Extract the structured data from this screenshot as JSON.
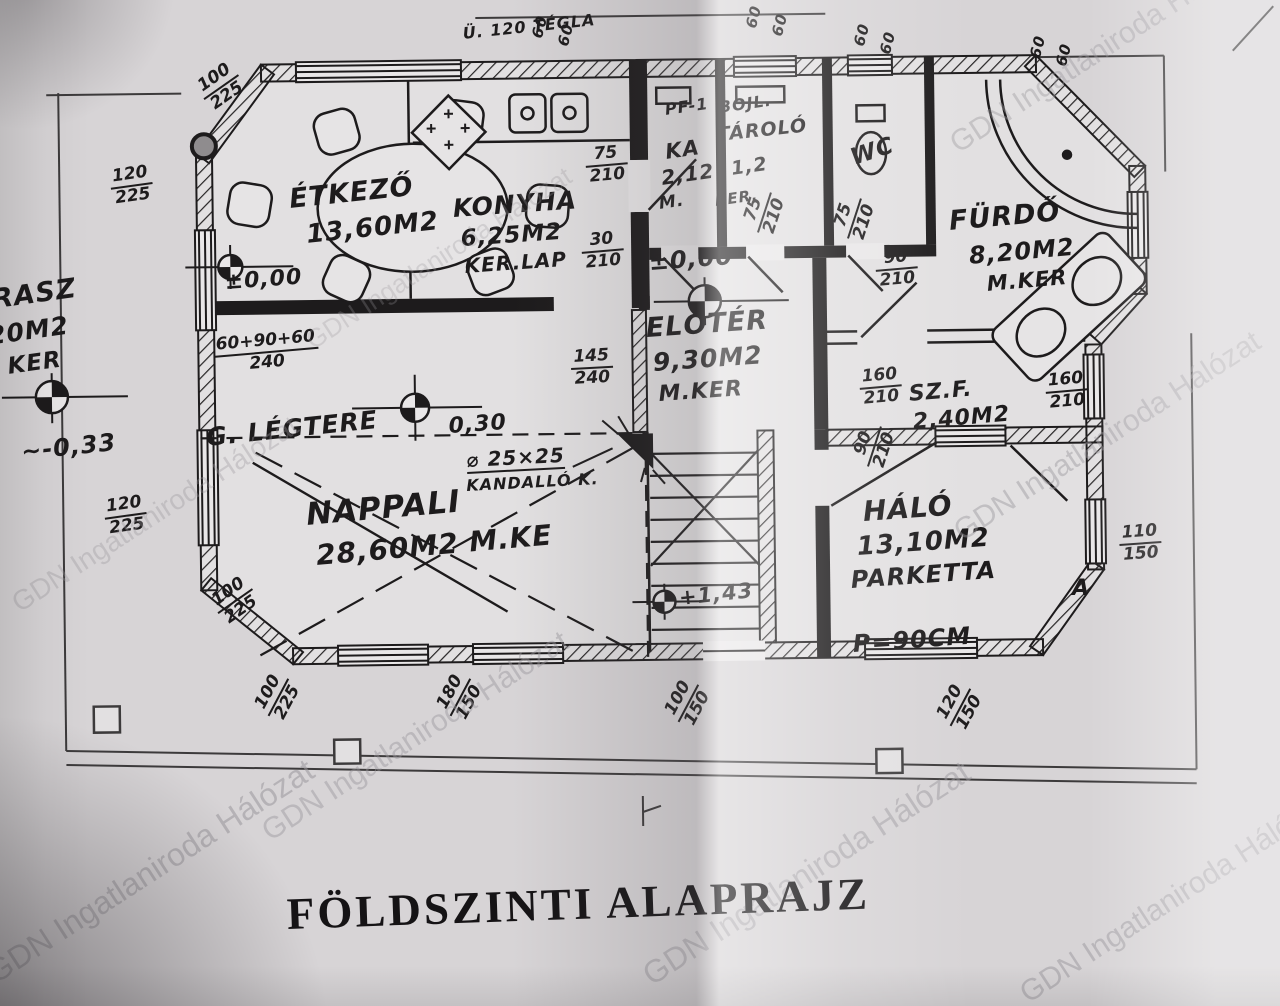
{
  "title": "FÖLDSZINTI ALAPRAJZ",
  "watermark_text": "GDN Ingatlaniroda Hálózat",
  "colors": {
    "paper": "#d7d4d6",
    "paper_bright": "#e9e7e8",
    "ink": "#1d1b1c",
    "watermark": "#9b989d"
  },
  "plan": {
    "labels": [
      {
        "n": "room-label-etkezo",
        "t": "ÉTKEZŐ",
        "x": 288,
        "y": 186,
        "s": 27,
        "r": -6
      },
      {
        "n": "room-area-etkezo",
        "t": "13,60M2",
        "x": 305,
        "y": 222,
        "s": 26,
        "r": -6
      },
      {
        "n": "room-label-konyha",
        "t": "KONYHA",
        "x": 452,
        "y": 196,
        "s": 25,
        "r": -4
      },
      {
        "n": "room-area-konyha",
        "t": "6,25M2",
        "x": 460,
        "y": 228,
        "s": 23,
        "r": -4
      },
      {
        "n": "room-floor-konyha",
        "t": "KER.LAP",
        "x": 464,
        "y": 256,
        "s": 20,
        "r": -4
      },
      {
        "n": "label-pf1",
        "t": "PF-1",
        "x": 664,
        "y": 102,
        "s": 16,
        "r": -8
      },
      {
        "n": "label-bojl",
        "t": "BOJL.",
        "x": 718,
        "y": 100,
        "s": 16,
        "r": -8
      },
      {
        "n": "room-label-tarolo",
        "t": "TÁROLÓ",
        "x": 716,
        "y": 126,
        "s": 19,
        "r": -6
      },
      {
        "n": "room-area-tarolo",
        "t": "1,2",
        "x": 730,
        "y": 160,
        "s": 19,
        "r": -8
      },
      {
        "n": "room-label-ka",
        "t": "KA",
        "x": 664,
        "y": 142,
        "s": 21,
        "r": -8
      },
      {
        "n": "room-area-ka",
        "t": "2,12",
        "x": 660,
        "y": 168,
        "s": 20,
        "r": -8
      },
      {
        "n": "room-floor-ka-m",
        "t": "M.",
        "x": 658,
        "y": 196,
        "s": 17,
        "r": -8
      },
      {
        "n": "room-floor-ka-ker",
        "t": "KER.",
        "x": 714,
        "y": 194,
        "s": 15,
        "r": -8
      },
      {
        "n": "room-label-wc",
        "t": "WC",
        "x": 848,
        "y": 148,
        "s": 23,
        "r": -18
      },
      {
        "n": "room-label-furdo",
        "t": "FÜRDŐ",
        "x": 948,
        "y": 208,
        "s": 27,
        "r": -5
      },
      {
        "n": "room-area-furdo",
        "t": "8,20M2",
        "x": 968,
        "y": 244,
        "s": 24,
        "r": -5
      },
      {
        "n": "room-floor-furdo",
        "t": "M.KER",
        "x": 986,
        "y": 274,
        "s": 21,
        "r": -5
      },
      {
        "n": "level-eloter",
        "t": "±0,00",
        "x": 648,
        "y": 250,
        "s": 24,
        "r": -4
      },
      {
        "n": "room-label-eloter",
        "t": "ELŐTÉR",
        "x": 645,
        "y": 315,
        "s": 27,
        "r": -4
      },
      {
        "n": "room-area-eloter",
        "t": "9,30M2",
        "x": 652,
        "y": 350,
        "s": 25,
        "r": -4
      },
      {
        "n": "room-floor-eloter",
        "t": "M.KER",
        "x": 658,
        "y": 384,
        "s": 22,
        "r": -4
      },
      {
        "n": "level-etkezo",
        "t": "±0,00",
        "x": 224,
        "y": 272,
        "s": 22,
        "r": -4
      },
      {
        "n": "room-label-szf",
        "t": "SZ.F.",
        "x": 908,
        "y": 384,
        "s": 22,
        "r": -5
      },
      {
        "n": "room-area-szf",
        "t": "2,40M2",
        "x": 912,
        "y": 412,
        "s": 22,
        "r": -5
      },
      {
        "n": "room-label-nappali",
        "t": "NAPPALI",
        "x": 305,
        "y": 500,
        "s": 31,
        "r": -5
      },
      {
        "n": "room-area-nappali",
        "t": "28,60M2 M.KE",
        "x": 315,
        "y": 542,
        "s": 28,
        "r": -5
      },
      {
        "n": "label-g-legtere",
        "t": "G. LÉGTERE",
        "x": 205,
        "y": 425,
        "s": 25,
        "r": -6
      },
      {
        "n": "level-nappali",
        "t": "0,30",
        "x": 448,
        "y": 416,
        "s": 22,
        "r": -4
      },
      {
        "n": "label-kandallo-size",
        "t": "⌀ 25×25",
        "x": 466,
        "y": 450,
        "s": 20,
        "r": -3,
        "u": true
      },
      {
        "n": "label-kandallo",
        "t": "KANDALLÓ K.",
        "x": 466,
        "y": 478,
        "s": 16,
        "r": -3
      },
      {
        "n": "room-label-halo",
        "t": "HÁLÓ",
        "x": 862,
        "y": 498,
        "s": 28,
        "r": -4
      },
      {
        "n": "room-area-halo",
        "t": "13,10M2",
        "x": 856,
        "y": 534,
        "s": 26,
        "r": -4
      },
      {
        "n": "room-floor-halo",
        "t": "PARKETTA",
        "x": 850,
        "y": 568,
        "s": 24,
        "r": -4
      },
      {
        "n": "label-parapet",
        "t": "P=90CM",
        "x": 852,
        "y": 632,
        "s": 24,
        "r": -4
      },
      {
        "n": "label-section-a",
        "t": "A",
        "x": 1072,
        "y": 578,
        "s": 22,
        "r": 0
      },
      {
        "n": "level-stairs",
        "t": "+1,43",
        "x": 678,
        "y": 588,
        "s": 21,
        "r": -6
      },
      {
        "n": "room-label-terasz",
        "t": "TERASZ",
        "x": -48,
        "y": 292,
        "s": 27,
        "r": -8
      },
      {
        "n": "room-area-terasz",
        "t": "5,20M2",
        "x": -42,
        "y": 328,
        "s": 25,
        "r": -8
      },
      {
        "n": "room-floor-terasz",
        "t": "M. KER",
        "x": -36,
        "y": 362,
        "s": 23,
        "r": -8
      },
      {
        "n": "level-terasz",
        "t": "~-0,33",
        "x": 20,
        "y": 440,
        "s": 24,
        "r": -6
      },
      {
        "n": "label-u120-tegla",
        "t": "Ü. 120 TÉGLA",
        "x": 462,
        "y": 26,
        "s": 16,
        "r": -6
      },
      {
        "n": "dim-window-60",
        "t": "60",
        "x": 530,
        "y": 36,
        "s": 15,
        "r": -75
      },
      {
        "n": "dim-window-60",
        "t": "60",
        "x": 556,
        "y": 44,
        "s": 15,
        "r": -75
      },
      {
        "n": "dim-window-60",
        "t": "60",
        "x": 744,
        "y": 26,
        "s": 15,
        "r": -75
      },
      {
        "n": "dim-window-60",
        "t": "60",
        "x": 770,
        "y": 34,
        "s": 15,
        "r": -75
      },
      {
        "n": "dim-window-60",
        "t": "60",
        "x": 852,
        "y": 44,
        "s": 15,
        "r": -75
      },
      {
        "n": "dim-window-60",
        "t": "60",
        "x": 878,
        "y": 52,
        "s": 15,
        "r": -75
      },
      {
        "n": "dim-window-60",
        "t": "60",
        "x": 1028,
        "y": 56,
        "s": 15,
        "r": -75
      },
      {
        "n": "dim-window-60",
        "t": "60",
        "x": 1054,
        "y": 64,
        "s": 15,
        "r": -75
      }
    ],
    "dims": [
      {
        "t": "120",
        "b": "225",
        "x": 108,
        "y": 168,
        "r": -8
      },
      {
        "t": "100",
        "b": "225",
        "x": 192,
        "y": 82,
        "r": -35
      },
      {
        "t": "60+90+60",
        "b": "240",
        "x": 212,
        "y": 336,
        "r": -5
      },
      {
        "t": "120",
        "b": "225",
        "x": 102,
        "y": 498,
        "r": -8
      },
      {
        "t": "100",
        "b": "225",
        "x": 206,
        "y": 596,
        "r": -35
      },
      {
        "t": "100",
        "b": "225",
        "x": 250,
        "y": 706,
        "r": -62
      },
      {
        "t": "180",
        "b": "150",
        "x": 432,
        "y": 706,
        "r": -62
      },
      {
        "t": "100",
        "b": "150",
        "x": 660,
        "y": 712,
        "r": -62
      },
      {
        "t": "120",
        "b": "150",
        "x": 932,
        "y": 716,
        "r": -62
      },
      {
        "t": "110",
        "b": "150",
        "x": 1118,
        "y": 524,
        "r": -4
      },
      {
        "t": "160",
        "b": "210",
        "x": 858,
        "y": 368,
        "r": -5
      },
      {
        "t": "160",
        "b": "210",
        "x": 1044,
        "y": 372,
        "r": -5
      },
      {
        "t": "90",
        "b": "210",
        "x": 874,
        "y": 250,
        "r": -5
      },
      {
        "t": "75",
        "b": "210",
        "x": 584,
        "y": 146,
        "r": -5
      },
      {
        "t": "30",
        "b": "210",
        "x": 580,
        "y": 232,
        "r": -5
      },
      {
        "t": "145",
        "b": "240",
        "x": 570,
        "y": 348,
        "r": -3
      },
      {
        "t": "75",
        "b": "210",
        "x": 738,
        "y": 226,
        "r": -72
      },
      {
        "t": "75",
        "b": "210",
        "x": 828,
        "y": 232,
        "r": -72
      },
      {
        "t": "90",
        "b": "210",
        "x": 848,
        "y": 460,
        "r": -72
      }
    ],
    "watermarks": [
      {
        "x": -20,
        "y": 960,
        "s": 32,
        "o": 0.55
      },
      {
        "x": 256,
        "y": 820,
        "s": 30,
        "o": 0.45
      },
      {
        "x": 636,
        "y": 962,
        "s": 32,
        "o": 0.5
      },
      {
        "x": 1014,
        "y": 982,
        "s": 30,
        "o": 0.5
      },
      {
        "x": 948,
        "y": 520,
        "s": 30,
        "o": 0.45
      },
      {
        "x": 944,
        "y": 132,
        "s": 30,
        "o": 0.4
      },
      {
        "x": 6,
        "y": 592,
        "s": 28,
        "o": 0.35
      },
      {
        "x": 300,
        "y": 330,
        "s": 26,
        "o": 0.28
      }
    ]
  }
}
